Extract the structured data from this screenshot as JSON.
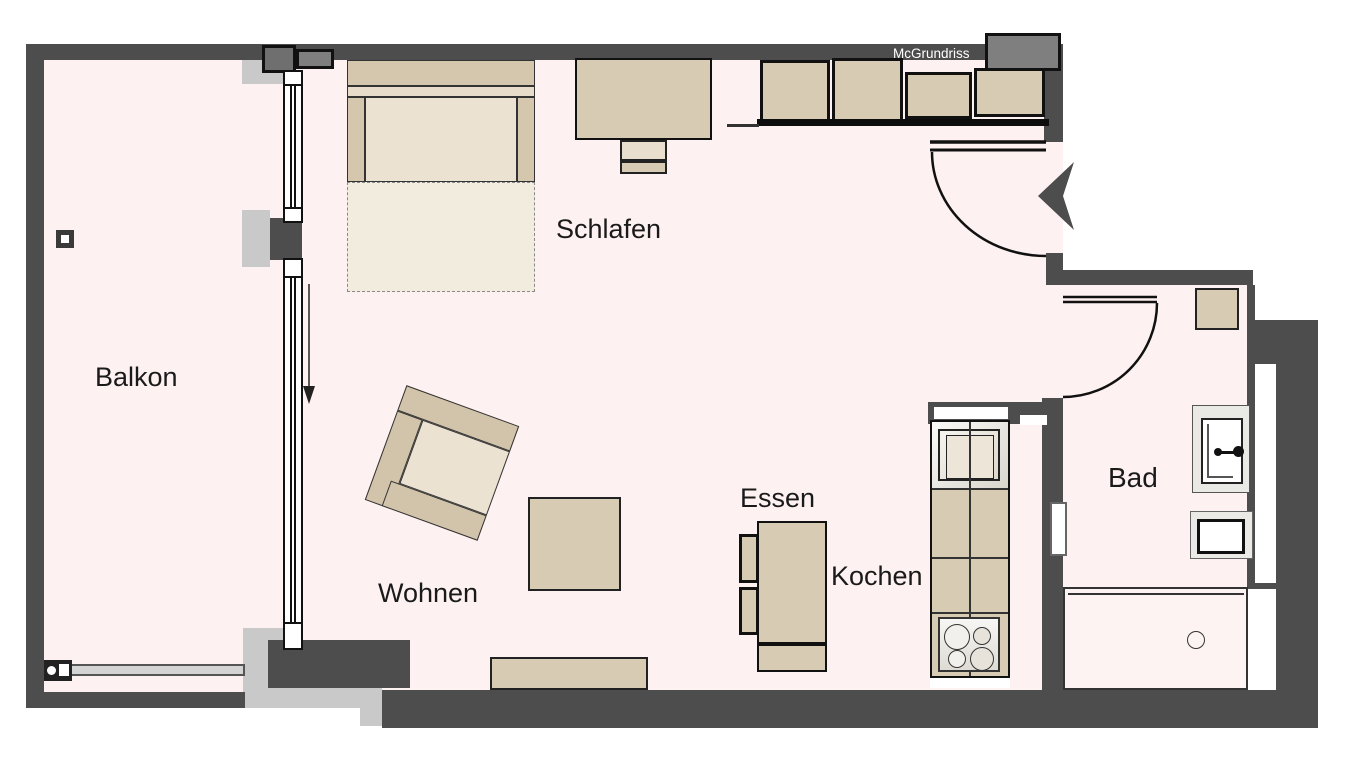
{
  "floorplan": {
    "watermark": "McGrundriss",
    "rooms": [
      {
        "name": "balcony",
        "label": "Balkon"
      },
      {
        "name": "bedroom",
        "label": "Schlafen"
      },
      {
        "name": "living",
        "label": "Wohnen"
      },
      {
        "name": "dining",
        "label": "Essen"
      },
      {
        "name": "kitchen",
        "label": "Kochen"
      },
      {
        "name": "bathroom",
        "label": "Bad"
      }
    ],
    "furniture": [
      "bed",
      "desk",
      "desk-chair",
      "wardrobe-cabinets",
      "armchair",
      "coffee-table",
      "sideboard",
      "dining-table",
      "dining-chairs",
      "kitchen-counter",
      "kitchen-sink",
      "stove",
      "bathroom-sink",
      "toilet",
      "shower",
      "wall-shelf",
      "balcony-railing",
      "entrance-door",
      "bathroom-door",
      "balcony-window",
      "balcony-sliding-door"
    ],
    "colors": {
      "wall": "#4d4d4d",
      "room_fill": "#fdf1f1",
      "furniture": "#d8cbb3",
      "accent_gray": "#c9c9c9",
      "outline": "#111111",
      "watermark_text": "#ffffff"
    }
  }
}
